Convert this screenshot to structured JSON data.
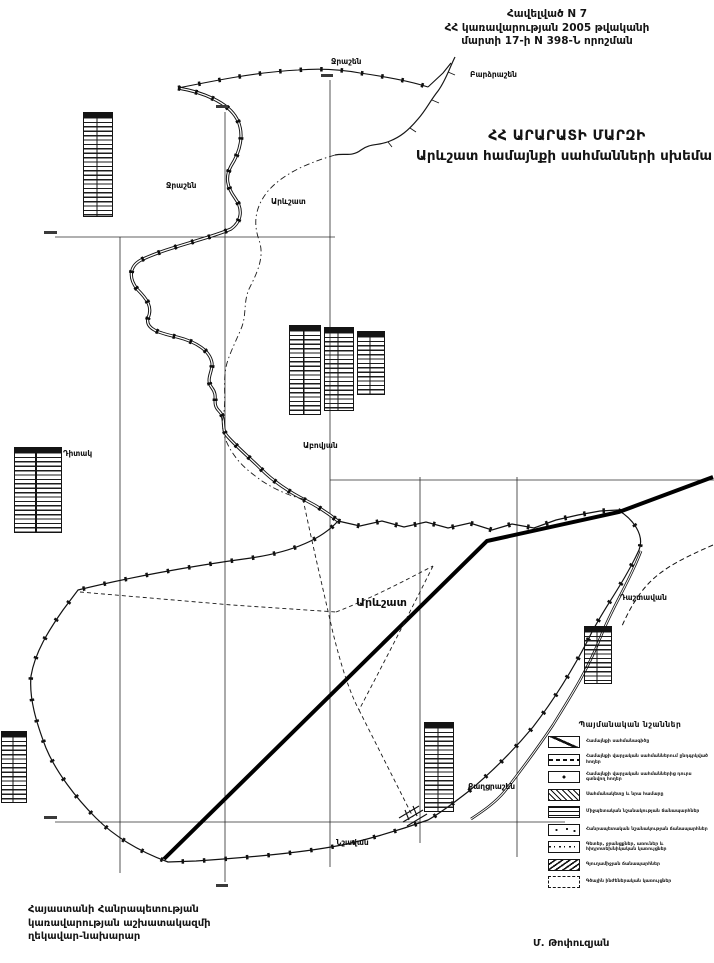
{
  "document": {
    "header": {
      "line1": "Հավելված N 7",
      "line2": "ՀՀ կառավարության 2005 թվականի",
      "line3": "մարտի 17-ի N 398-Ն որոշման"
    },
    "title": {
      "line1": "ՀՀ ԱՐԱՐԱՏԻ ՄԱՐԶԻ",
      "line2": "Արևշատ  համայնքի սահմանների սխեմա"
    },
    "footer": {
      "left_line1": "Հայաստանի Հանրապետության",
      "left_line2": "կառավարության աշխատակազմի",
      "left_line3": "ղեկավար-նախարար",
      "signature": "Մ. Թոփուզյան"
    }
  },
  "map": {
    "ink_color": "#141414",
    "labels": {
      "jrashen_north": "Ջրաշեն",
      "bardzrashen": "Բարձրաշեն",
      "jrashen_west": "Ջրաշեն",
      "arevshat_north": "Արևշատ",
      "abovyan": "Աբովյան",
      "ditak": "Դիտակ",
      "arevshat_main": "Արևշատ",
      "dashtavan": "Դաշտավան",
      "kaghtsrashen": "Քաղցրաշեն",
      "nshavan": "Նշավան"
    }
  },
  "legend": {
    "title": "Պայմանական նշաններ",
    "items": [
      "Համայնքի սահմանագիծը",
      "Համայնքի վարչական սահմաններում ընդգրկված հողեր",
      "Համայնքի վարչական սահմաններից դուրս գտնվող հողեր",
      "Սահմանակետը և նրա համարը",
      "Միջպետական նշանակության ճանապարհներ",
      "Հանրապետական նշանակության ճանապարհներ",
      "Գետեր, ջրանցքներ, առուներ և հիդրոտեխնիկական կառույցներ",
      "Գյուղամիջյան ճանապարհներ",
      "Գծային ինժեներական կառույցներ"
    ]
  }
}
